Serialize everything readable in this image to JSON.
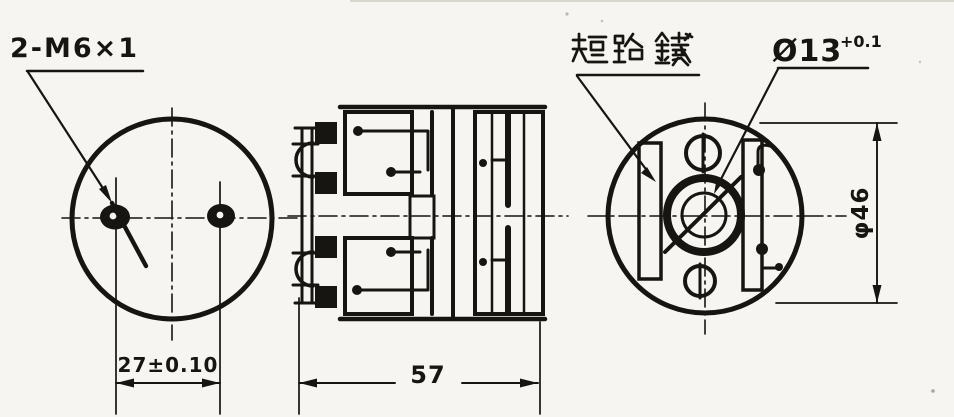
{
  "page": {
    "kind": "scanned engineering drawing, three orthographic views of a cylindrical electrical component",
    "paper_color": "#f7f5f1",
    "ink_color": "#161512"
  },
  "callouts": {
    "thread": "2-M6×1",
    "shading": "短路鐵",
    "hole": "Ø13",
    "hole_sup": "+0.1"
  },
  "dimensions": {
    "stud_spacing": "27±0.10",
    "body_length": "57",
    "outer_diameter": "φ46"
  }
}
